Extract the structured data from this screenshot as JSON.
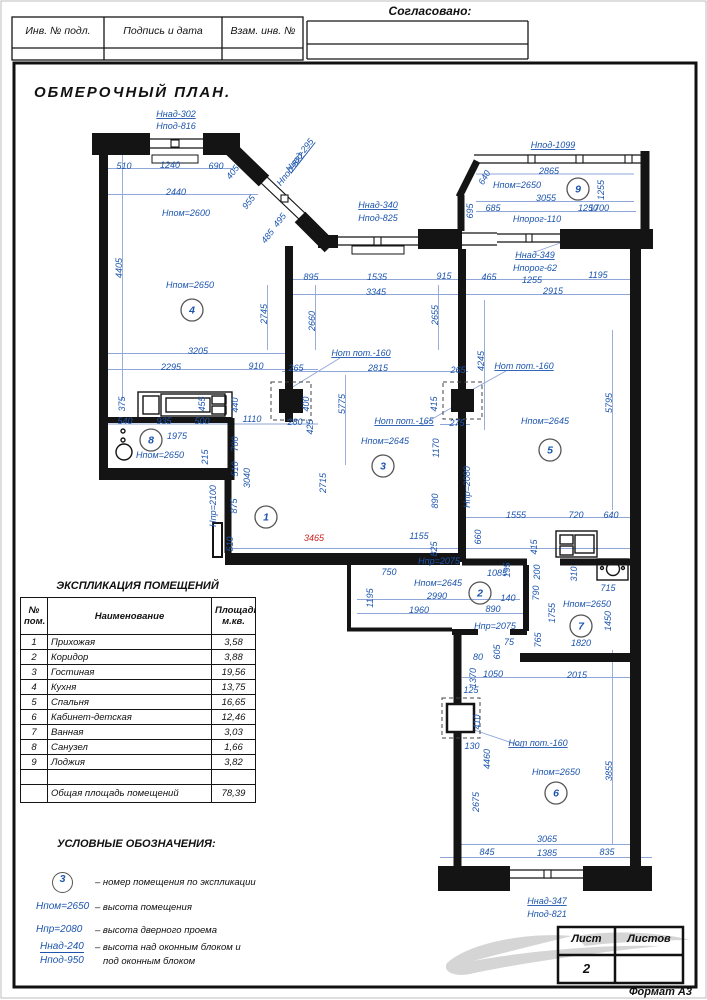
{
  "header": {
    "approved_label": "Согласовано:",
    "cells": [
      "Инв. № подл.",
      "Подпись и дата",
      "Взам. инв. №"
    ]
  },
  "title": "ОБМЕРОЧНЫЙ ПЛАН.",
  "explication": {
    "title": "ЭКСПЛИКАЦИЯ ПОМЕЩЕНИЙ",
    "col_headers": [
      "№ пом.",
      "Наименование",
      "Площадь м.кв."
    ],
    "rows": [
      [
        "1",
        "Прихожая",
        "3,58"
      ],
      [
        "2",
        "Коридор",
        "3,88"
      ],
      [
        "3",
        "Гостиная",
        "19,56"
      ],
      [
        "4",
        "Кухня",
        "13,75"
      ],
      [
        "5",
        "Спальня",
        "16,65"
      ],
      [
        "6",
        "Кабинет-детская",
        "12,46"
      ],
      [
        "7",
        "Ванная",
        "3,03"
      ],
      [
        "8",
        "Санузел",
        "1,66"
      ],
      [
        "9",
        "Лоджия",
        "3,82"
      ],
      [
        "",
        "",
        ""
      ]
    ],
    "total_label": "Общая площадь помещений",
    "total_value": "78,39"
  },
  "legend": {
    "title": "УСЛОВНЫЕ ОБОЗНАЧЕНИЯ:",
    "circle_symbol": "3",
    "items": [
      {
        "text": "–  номер помещения по экспликации"
      },
      {
        "symbol": "Нпом=2650",
        "text": "–  высота помещения"
      },
      {
        "symbol": "Нпр=2080",
        "text": "–  высота дверного проема"
      },
      {
        "symbol": "Ннад-240",
        "symbol2": "Нпод-950",
        "text": "–  высота над оконным блоком и",
        "text2": "под оконным блоком"
      }
    ]
  },
  "title_block": {
    "sheet_label": "Лист",
    "sheets_label": "Листов",
    "sheet_number": "2",
    "format_label": "Формат А3"
  },
  "colors": {
    "dimension_blue": "#1c55ae",
    "dim_line_blue": "#8fa6d8",
    "highlight_red": "#cc2020",
    "wall_black": "#141414"
  },
  "plan": {
    "rooms": [
      {
        "n": "1",
        "x": 266,
        "y": 517
      },
      {
        "n": "2",
        "x": 480,
        "y": 593
      },
      {
        "n": "3",
        "x": 383,
        "y": 466
      },
      {
        "n": "4",
        "x": 192,
        "y": 310
      },
      {
        "n": "5",
        "x": 550,
        "y": 450
      },
      {
        "n": "6",
        "x": 556,
        "y": 793
      },
      {
        "n": "7",
        "x": 581,
        "y": 626
      },
      {
        "n": "8",
        "x": 151,
        "y": 440
      },
      {
        "n": "9",
        "x": 578,
        "y": 189
      }
    ],
    "labels": [
      {
        "t": "Ннад-302",
        "x": 176,
        "y": 117,
        "u": 1
      },
      {
        "t": "Нпод-816",
        "x": 176,
        "y": 129
      },
      {
        "t": "510",
        "x": 124,
        "y": 169
      },
      {
        "t": "1240",
        "x": 170,
        "y": 168
      },
      {
        "t": "690",
        "x": 216,
        "y": 169
      },
      {
        "t": "405",
        "x": 235,
        "y": 174,
        "r": -52
      },
      {
        "t": "2440",
        "x": 176,
        "y": 195
      },
      {
        "t": "Нпом=2600",
        "x": 186,
        "y": 216,
        "s": 10
      },
      {
        "t": "955",
        "x": 251,
        "y": 204,
        "r": -52
      },
      {
        "t": "495",
        "x": 282,
        "y": 222,
        "r": -52
      },
      {
        "t": "485",
        "x": 270,
        "y": 238,
        "r": -52
      },
      {
        "t": "Ннад-295",
        "x": 302,
        "y": 157,
        "r": -52,
        "u": 1
      },
      {
        "t": "Нпод-822",
        "x": 293,
        "y": 171,
        "r": -52
      },
      {
        "t": "Ннад-340",
        "x": 378,
        "y": 208,
        "u": 1
      },
      {
        "t": "Нпод-825",
        "x": 378,
        "y": 221
      },
      {
        "t": "Нпод-1099",
        "x": 553,
        "y": 148,
        "u": 1
      },
      {
        "t": "2865",
        "x": 549,
        "y": 174
      },
      {
        "t": "Нпом=2650",
        "x": 517,
        "y": 188,
        "s": 10
      },
      {
        "t": "3055",
        "x": 546,
        "y": 201
      },
      {
        "t": "1255",
        "x": 604,
        "y": 190,
        "r": -90
      },
      {
        "t": "640",
        "x": 487,
        "y": 179,
        "r": -60
      },
      {
        "t": "695",
        "x": 473,
        "y": 211,
        "r": -90
      },
      {
        "t": "685",
        "x": 493,
        "y": 211
      },
      {
        "t": "Нпорог-110",
        "x": 537,
        "y": 222
      },
      {
        "t": "1250",
        "x": 588,
        "y": 211
      },
      {
        "t": "1700",
        "x": 599,
        "y": 211
      },
      {
        "t": "Ннад-349",
        "x": 535,
        "y": 258,
        "u": 1
      },
      {
        "t": "Нпорог-62",
        "x": 535,
        "y": 271
      },
      {
        "t": "1255",
        "x": 532,
        "y": 283
      },
      {
        "t": "1195",
        "x": 598,
        "y": 278
      },
      {
        "t": "2915",
        "x": 553,
        "y": 294
      },
      {
        "t": "895",
        "x": 311,
        "y": 280
      },
      {
        "t": "1535",
        "x": 377,
        "y": 280
      },
      {
        "t": "915",
        "x": 444,
        "y": 279
      },
      {
        "t": "465",
        "x": 489,
        "y": 280
      },
      {
        "t": "3345",
        "x": 376,
        "y": 295
      },
      {
        "t": "4405",
        "x": 122,
        "y": 268,
        "r": -90
      },
      {
        "t": "Нпом=2650",
        "x": 190,
        "y": 288,
        "s": 10
      },
      {
        "t": "2745",
        "x": 267,
        "y": 314,
        "r": -90
      },
      {
        "t": "2660",
        "x": 315,
        "y": 321,
        "r": -90
      },
      {
        "t": "3205",
        "x": 198,
        "y": 354
      },
      {
        "t": "2295",
        "x": 171,
        "y": 370
      },
      {
        "t": "910",
        "x": 256,
        "y": 369
      },
      {
        "t": "265",
        "x": 296,
        "y": 371
      },
      {
        "t": "Нот пот.-160",
        "x": 361,
        "y": 356,
        "u": 1
      },
      {
        "t": "2815",
        "x": 378,
        "y": 371
      },
      {
        "t": "5775",
        "x": 345,
        "y": 404,
        "r": -90
      },
      {
        "t": "2655",
        "x": 438,
        "y": 315,
        "r": -90
      },
      {
        "t": "265",
        "x": 458,
        "y": 373
      },
      {
        "t": "Нот пот.-165",
        "x": 404,
        "y": 424,
        "u": 1
      },
      {
        "t": "Нпом=2645",
        "x": 385,
        "y": 444,
        "s": 10
      },
      {
        "t": "415",
        "x": 437,
        "y": 404,
        "r": -90
      },
      {
        "t": "275",
        "x": 457,
        "y": 426
      },
      {
        "t": "400",
        "x": 309,
        "y": 404,
        "r": -90
      },
      {
        "t": "425",
        "x": 313,
        "y": 427,
        "r": -90
      },
      {
        "t": "280",
        "x": 295,
        "y": 425
      },
      {
        "t": "1170",
        "x": 439,
        "y": 448,
        "r": -90
      },
      {
        "t": "890",
        "x": 438,
        "y": 501,
        "r": -90
      },
      {
        "t": "Нпр=2080",
        "x": 470,
        "y": 487,
        "r": -90
      },
      {
        "t": "2715",
        "x": 326,
        "y": 483,
        "r": -90
      },
      {
        "t": "4245",
        "x": 484,
        "y": 361,
        "r": -90
      },
      {
        "t": "Нот пот.-160",
        "x": 524,
        "y": 369,
        "u": 1
      },
      {
        "t": "Нпом=2645",
        "x": 545,
        "y": 424,
        "s": 10
      },
      {
        "t": "5795",
        "x": 612,
        "y": 403,
        "r": -90
      },
      {
        "t": "1555",
        "x": 516,
        "y": 518
      },
      {
        "t": "720",
        "x": 576,
        "y": 518
      },
      {
        "t": "640",
        "x": 611,
        "y": 518
      },
      {
        "t": "660",
        "x": 481,
        "y": 537,
        "r": -90
      },
      {
        "t": "415",
        "x": 537,
        "y": 547,
        "r": -90
      },
      {
        "t": "375",
        "x": 125,
        "y": 404,
        "r": -90
      },
      {
        "t": "540",
        "x": 125,
        "y": 424
      },
      {
        "t": "935",
        "x": 164,
        "y": 424
      },
      {
        "t": "500",
        "x": 202,
        "y": 424
      },
      {
        "t": "455",
        "x": 205,
        "y": 404,
        "r": -90
      },
      {
        "t": "440",
        "x": 238,
        "y": 405,
        "r": -90
      },
      {
        "t": "1110",
        "x": 252,
        "y": 422
      },
      {
        "t": "1975",
        "x": 177,
        "y": 439
      },
      {
        "t": "Нпом=2650",
        "x": 160,
        "y": 458,
        "s": 10
      },
      {
        "t": "215",
        "x": 208,
        "y": 457,
        "r": -90
      },
      {
        "t": "700",
        "x": 238,
        "y": 444,
        "r": -90
      },
      {
        "t": "510",
        "x": 238,
        "y": 469,
        "r": -90
      },
      {
        "t": "3040",
        "x": 250,
        "y": 478,
        "r": -90
      },
      {
        "t": "Нпр=2100",
        "x": 216,
        "y": 506,
        "r": -90
      },
      {
        "t": "875",
        "x": 237,
        "y": 506,
        "r": -90
      },
      {
        "t": "510",
        "x": 233,
        "y": 544,
        "r": -90
      },
      {
        "t": "3465",
        "x": 314,
        "y": 541,
        "c": "red"
      },
      {
        "t": "1155",
        "x": 419,
        "y": 539
      },
      {
        "t": "825",
        "x": 437,
        "y": 549,
        "r": -90
      },
      {
        "t": "Нпр=2075",
        "x": 439,
        "y": 564
      },
      {
        "t": "750",
        "x": 389,
        "y": 575
      },
      {
        "t": "Нпом=2645",
        "x": 438,
        "y": 586,
        "s": 10
      },
      {
        "t": "2990",
        "x": 437,
        "y": 599
      },
      {
        "t": "140",
        "x": 508,
        "y": 601
      },
      {
        "t": "890",
        "x": 493,
        "y": 612
      },
      {
        "t": "1960",
        "x": 419,
        "y": 613
      },
      {
        "t": "1195",
        "x": 373,
        "y": 598,
        "r": -90
      },
      {
        "t": "1085",
        "x": 497,
        "y": 576
      },
      {
        "t": "195",
        "x": 510,
        "y": 570,
        "r": -90
      },
      {
        "t": "200",
        "x": 540,
        "y": 572,
        "r": -90
      },
      {
        "t": "310",
        "x": 577,
        "y": 574,
        "r": -90
      },
      {
        "t": "715",
        "x": 608,
        "y": 591
      },
      {
        "t": "Нпр=2075",
        "x": 495,
        "y": 629
      },
      {
        "t": "75",
        "x": 509,
        "y": 645
      },
      {
        "t": "605",
        "x": 500,
        "y": 652,
        "r": -90
      },
      {
        "t": "80",
        "x": 478,
        "y": 660
      },
      {
        "t": "1370",
        "x": 476,
        "y": 678,
        "r": -90
      },
      {
        "t": "1050",
        "x": 493,
        "y": 677
      },
      {
        "t": "2015",
        "x": 577,
        "y": 678
      },
      {
        "t": "125",
        "x": 471,
        "y": 693
      },
      {
        "t": "Нпом=2650",
        "x": 587,
        "y": 607,
        "s": 10
      },
      {
        "t": "1450",
        "x": 611,
        "y": 621,
        "r": -90
      },
      {
        "t": "1820",
        "x": 581,
        "y": 646
      },
      {
        "t": "765",
        "x": 541,
        "y": 640,
        "r": -90
      },
      {
        "t": "1755",
        "x": 555,
        "y": 613,
        "r": -90
      },
      {
        "t": "790",
        "x": 539,
        "y": 593,
        "r": -90
      },
      {
        "t": "410",
        "x": 480,
        "y": 722,
        "r": -90
      },
      {
        "t": "130",
        "x": 472,
        "y": 749
      },
      {
        "t": "4460",
        "x": 490,
        "y": 759,
        "r": -90
      },
      {
        "t": "Нот пот.-160",
        "x": 538,
        "y": 746,
        "u": 1
      },
      {
        "t": "Нпом=2650",
        "x": 556,
        "y": 775,
        "s": 10
      },
      {
        "t": "3855",
        "x": 612,
        "y": 771,
        "r": -90
      },
      {
        "t": "2675",
        "x": 479,
        "y": 802,
        "r": -90
      },
      {
        "t": "3065",
        "x": 547,
        "y": 842
      },
      {
        "t": "845",
        "x": 487,
        "y": 855
      },
      {
        "t": "1385",
        "x": 547,
        "y": 856
      },
      {
        "t": "835",
        "x": 607,
        "y": 855
      },
      {
        "t": "Ннад-347",
        "x": 547,
        "y": 904,
        "u": 1
      },
      {
        "t": "Нпод-821",
        "x": 547,
        "y": 917
      }
    ]
  }
}
